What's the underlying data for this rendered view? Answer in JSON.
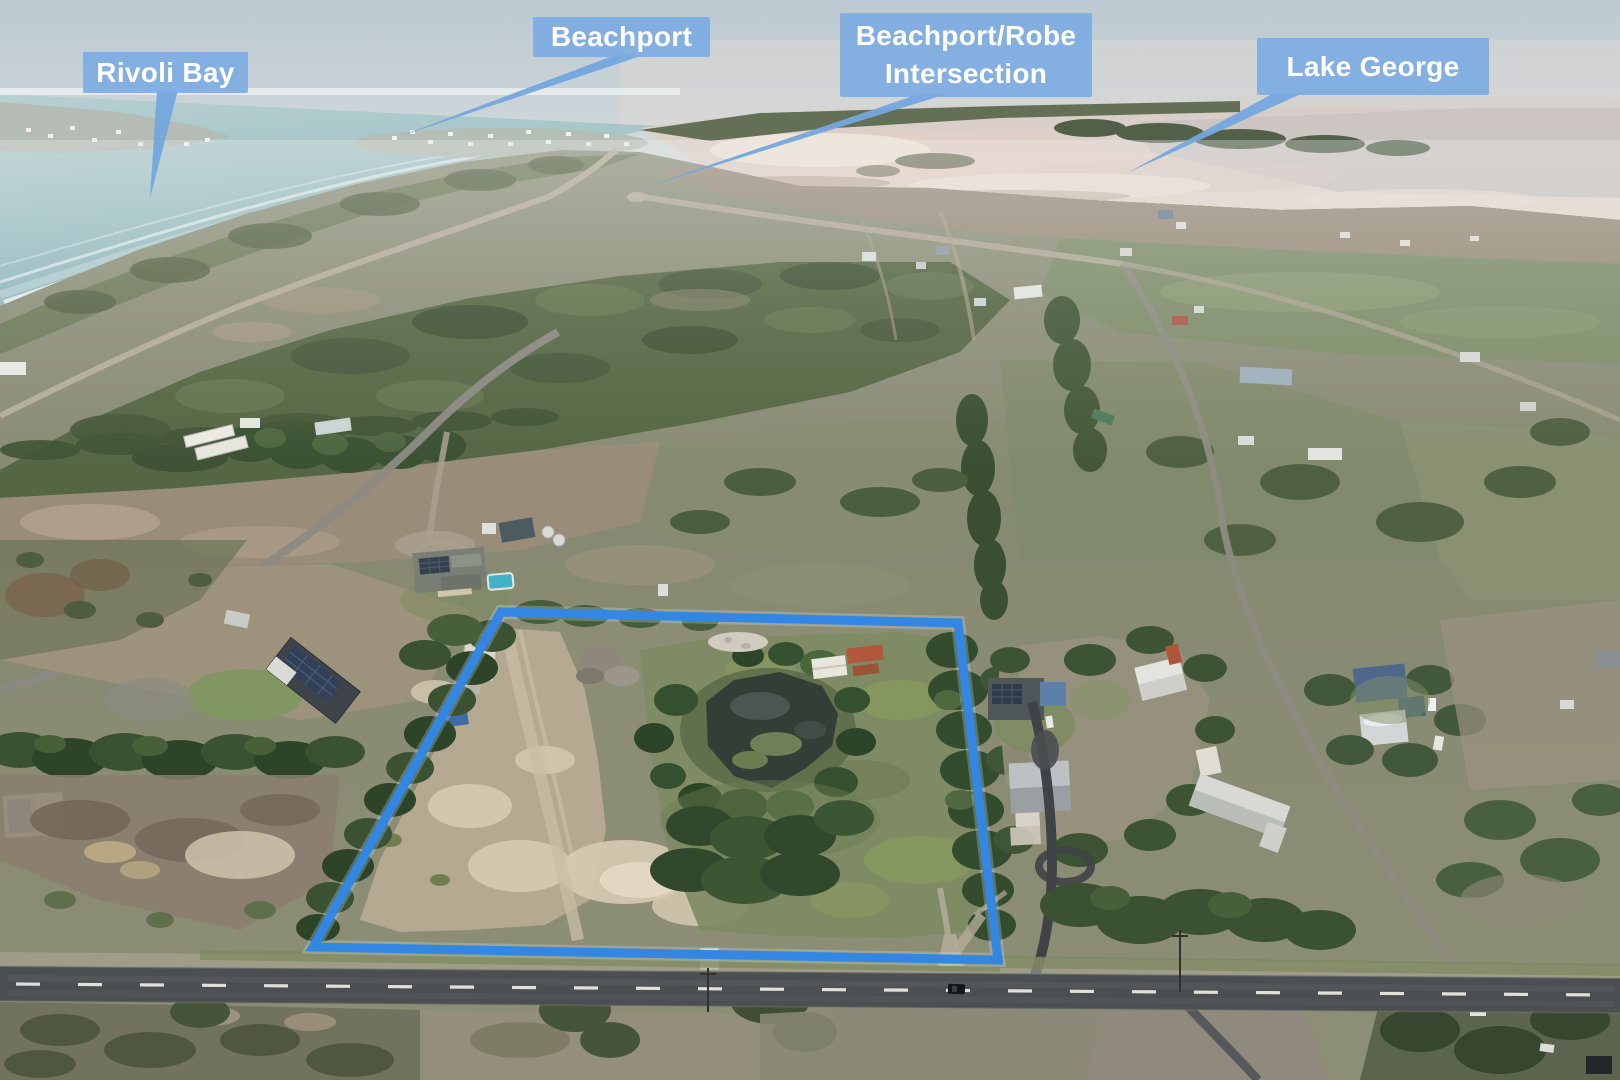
{
  "photo": {
    "type": "aerial-drone-photograph",
    "scene": "Rural coastal acreage outlined in blue with dam, sheds and tree belts; ocean and Beachport township behind, Lake George salt lake to the right, sealed road in the foreground",
    "label_bg_color": "#7dabe2",
    "label_text_color": "#ffffff",
    "boundary_color": "#3387e2",
    "leader_color": "#74a6de"
  },
  "labels": [
    {
      "id": "rivoli-bay",
      "text": "Rivoli Bay",
      "leader_points": "157,90 178,90 150,198"
    },
    {
      "id": "beachport",
      "text": "Beachport",
      "leader_points": "615,55 644,55 398,137"
    },
    {
      "id": "beachport-robe-intersection",
      "text": "Beachport/Robe Intersection",
      "leader_points": "919,94 947,94 633,191"
    },
    {
      "id": "lake-george",
      "text": "Lake George",
      "leader_points": "1274,93 1303,93 1127,173"
    }
  ],
  "boundary": {
    "points": "501,612 958,623 998,960 313,947"
  }
}
